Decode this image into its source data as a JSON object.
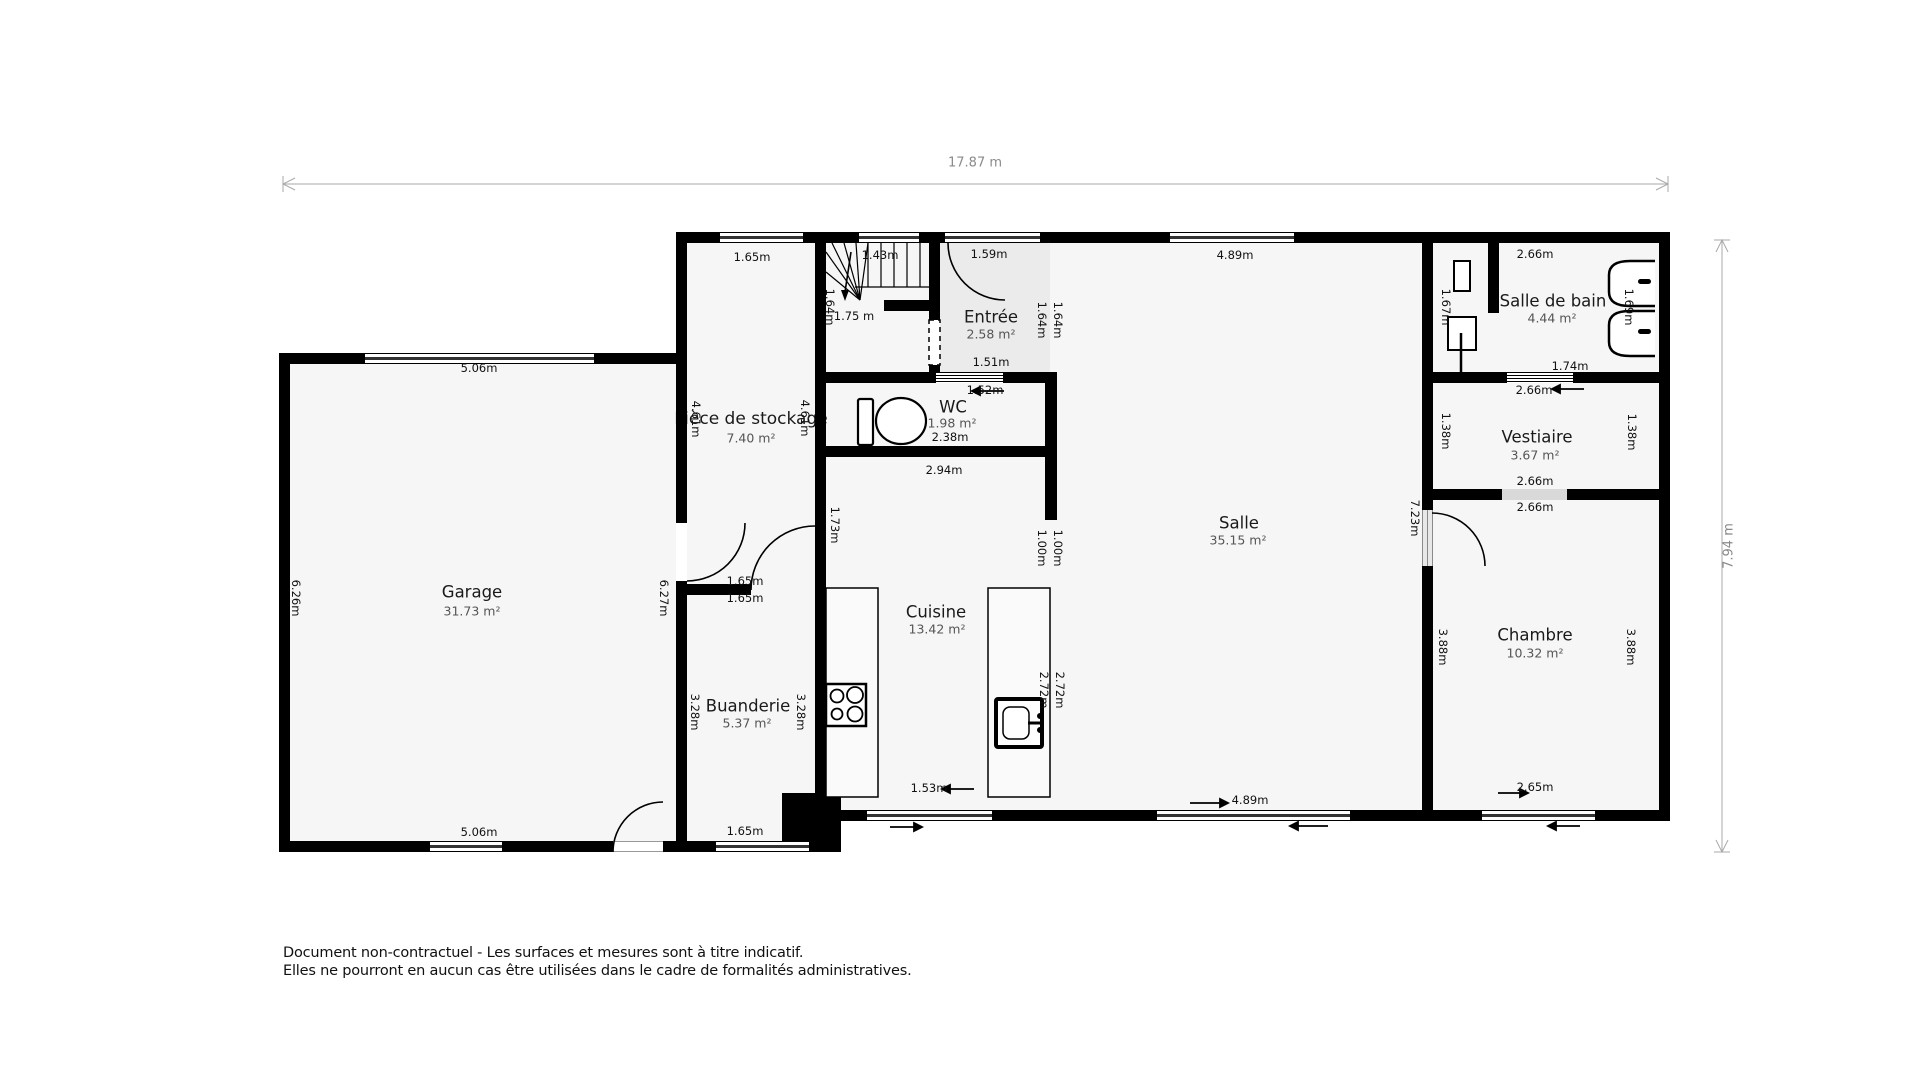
{
  "plan": {
    "overall_width": "17.87 m",
    "overall_height": "7.94 m"
  },
  "rooms": {
    "garage": {
      "name": "Garage",
      "area": "31.73 m²"
    },
    "stockage": {
      "name": "Pièce de stockage",
      "area": "7.40 m²"
    },
    "buanderie": {
      "name": "Buanderie",
      "area": "5.37 m²"
    },
    "entree": {
      "name": "Entrée",
      "area": "2.58 m²"
    },
    "wc": {
      "name": "WC",
      "area": "1.98 m²"
    },
    "cuisine": {
      "name": "Cuisine",
      "area": "13.42 m²"
    },
    "salle": {
      "name": "Salle",
      "area": "35.15 m²"
    },
    "sdb": {
      "name": "Salle de bain",
      "area": "4.44 m²"
    },
    "vestiaire": {
      "name": "Vestiaire",
      "area": "3.67 m²"
    },
    "chambre": {
      "name": "Chambre",
      "area": "10.32 m²"
    }
  },
  "dims": {
    "garage_top": "5.06m",
    "garage_bottom": "5.06m",
    "garage_left": "6.26m",
    "garage_right": "6.27m",
    "stockage_top": "1.65m",
    "stockage_left": "4.61m",
    "stockage_right": "4.61m",
    "stockage_bottom_a": "1.65m",
    "stockage_bottom_b": "1.65m",
    "buanderie_left": "3.28m",
    "buanderie_right": "3.28m",
    "buanderie_bottom": "1.65m",
    "stairs_top": "1.43m",
    "stairs_side": "1.64m",
    "stairs_bottom": "1.75 m",
    "entree_top": "1.59m",
    "entree_bottom": "1.51m",
    "entree_right_a": "1.64m",
    "entree_right_b": "1.64m",
    "wc_top": "1.52m",
    "wc_width": "2.38m",
    "below_wc": "2.94m",
    "cuisine_wall": "1.73m",
    "passage_a": "1.00m",
    "passage_b": "1.00m",
    "counter_left": "2.72m",
    "counter_right_a": "2.72m",
    "counter_right_b": "2.72m",
    "cuisine_bottom": "1.53m",
    "salle_top": "4.89m",
    "salle_bottom": "4.89m",
    "salle_right": "7.23m",
    "sdb_top": "2.66m",
    "sdb_left": "1.67m",
    "sdb_sink": "1.69m",
    "sdb_bottom": "1.74m",
    "sdb_below": "2.66m",
    "vest_left": "1.38m",
    "vest_right": "1.38m",
    "vest_bottom": "2.66m",
    "chambre_top": "2.66m",
    "chambre_left": "3.88m",
    "chambre_right": "3.88m",
    "chambre_bottom": "2.65m"
  },
  "footer": {
    "line1": "Document non-contractuel - Les surfaces et mesures sont à titre indicatif.",
    "line2": "Elles ne pourront en aucun cas être utilisées dans le cadre de formalités administratives."
  }
}
